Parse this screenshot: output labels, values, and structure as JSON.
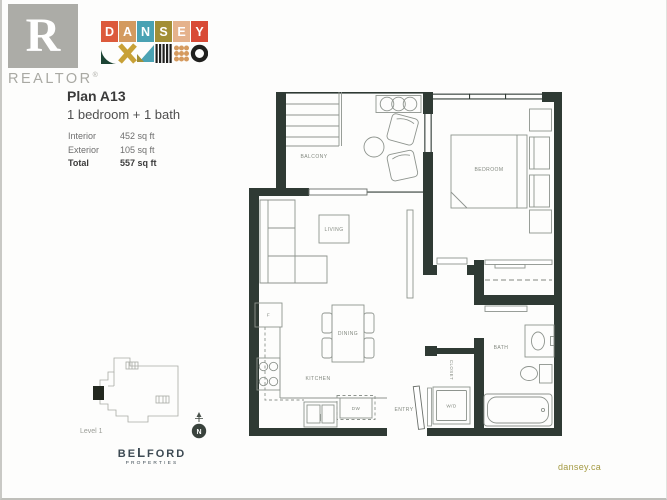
{
  "branding": {
    "realtor": {
      "letter": "R",
      "label": "REALTOR",
      "reg": "®"
    },
    "dansey": {
      "letters": [
        {
          "char": "D",
          "style": "background:#dc5a3c"
        },
        {
          "char": "A",
          "style": "background:#d39a5f"
        },
        {
          "char": "N",
          "style": "background:#4aa2b3"
        },
        {
          "char": "S",
          "style": "background:#a28e35"
        },
        {
          "char": "E",
          "style": "background:#e5b28c"
        },
        {
          "char": "Y",
          "style": "background:#d84a36"
        }
      ],
      "shape_colors": {
        "green": "#1c4434",
        "gold": "#c8a136",
        "teal": "#4ba3b4",
        "olive": "#a28f35",
        "black": "#20201e",
        "dot": "#d59a5e"
      }
    },
    "belford": {
      "part1": "BE",
      "part_l": "L",
      "part2": "FORD",
      "line2": "PROPERTIES"
    },
    "website": "dansey.ca"
  },
  "plan": {
    "title": "Plan A13",
    "subtitle": "1 bedroom + 1 bath",
    "stats": {
      "interior_label": "Interior",
      "interior_value": "452 sq ft",
      "exterior_label": "Exterior",
      "exterior_value": "105 sq ft",
      "total_label": "Total",
      "total_value": "557 sq ft"
    }
  },
  "floorplan": {
    "labels": {
      "balcony": "BALCONY",
      "bedroom": "BEDROOM",
      "living": "LIVING",
      "dining": "DINING",
      "kitchen": "KITCHEN",
      "bath": "BATH",
      "entry": "ENTRY",
      "washer_dryer": "W/D",
      "dishwasher": "DW",
      "fridge": "F",
      "closet": "CLOSET"
    },
    "compass_n": "N",
    "colors": {
      "wall": "#2f3a34",
      "furniture_line": "#8e948e",
      "label_text": "#82887f"
    }
  },
  "keyplan": {
    "label": "Level 1"
  }
}
